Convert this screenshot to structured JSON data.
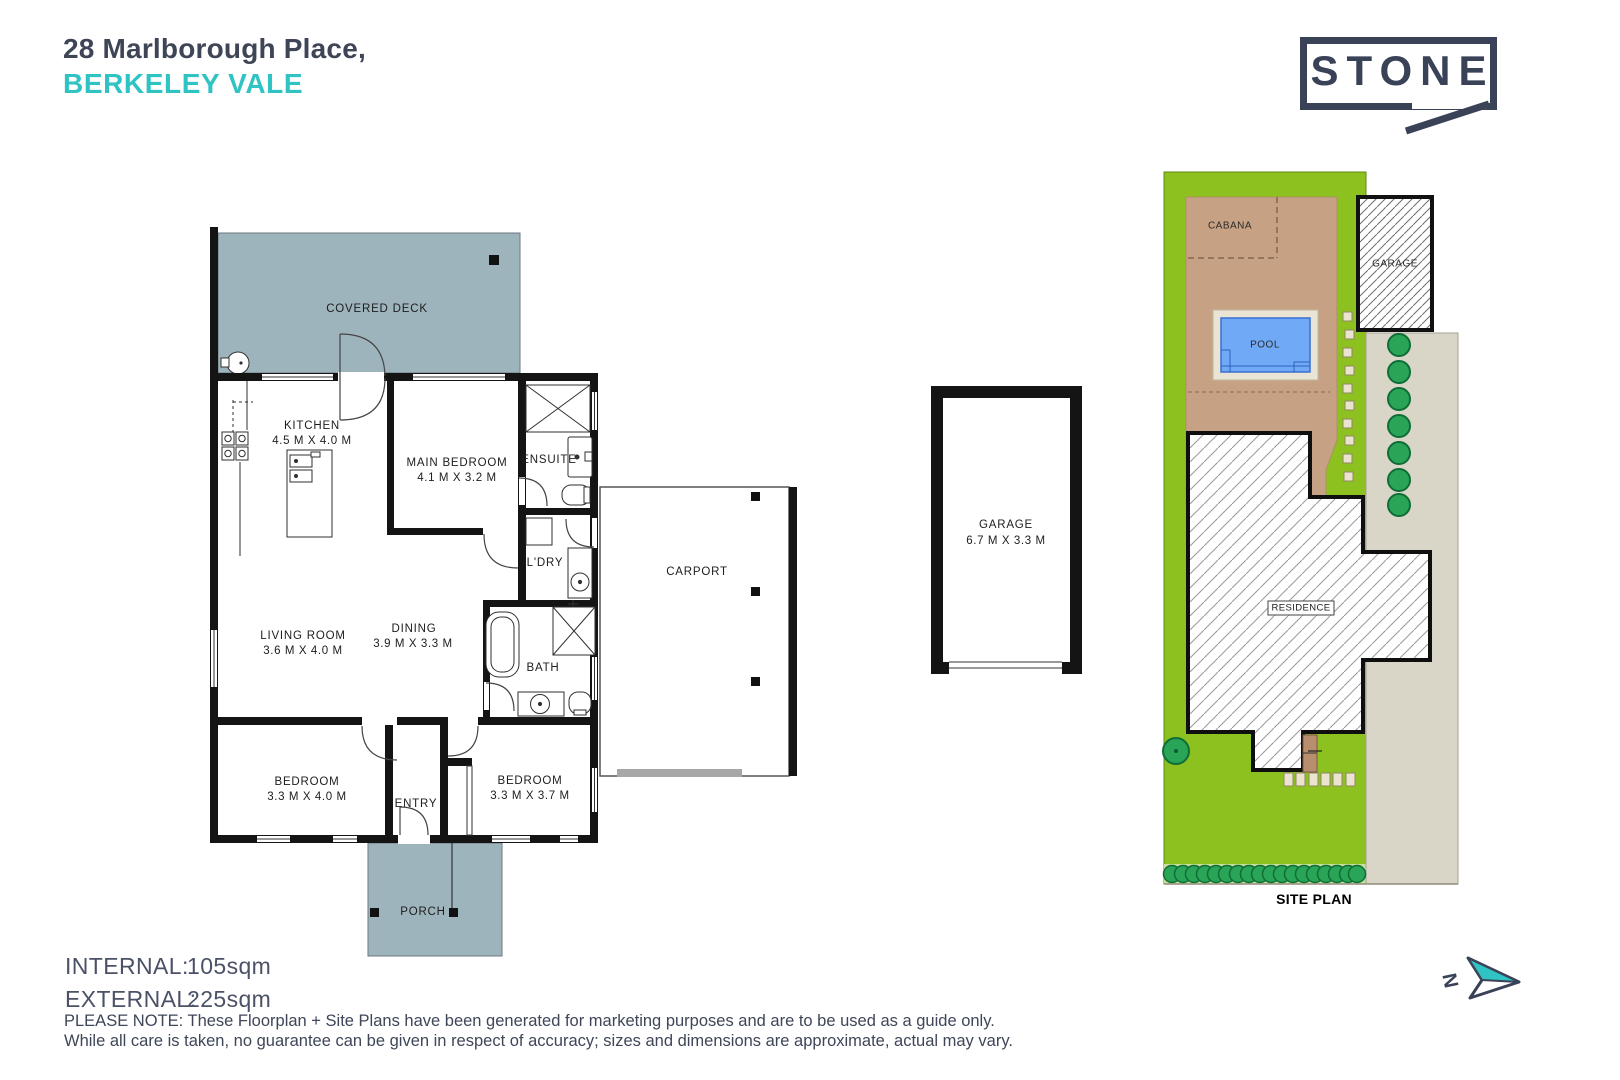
{
  "header": {
    "address_line1": "28 Marlborough Place,",
    "address_line2": "BERKELEY VALE"
  },
  "brand": {
    "logo_text": "STONE",
    "navy": "#3a4257",
    "teal": "#2fc3c3"
  },
  "floorplan": {
    "rooms": {
      "covered_deck": {
        "name": "COVERED DECK"
      },
      "kitchen": {
        "name": "KITCHEN",
        "dims": "4.5 M X 4.0 M"
      },
      "main_bedroom": {
        "name": "MAIN BEDROOM",
        "dims": "4.1 M X 3.2 M"
      },
      "ensuite": {
        "name": "ENSUITE"
      },
      "laundry": {
        "name": "L'DRY"
      },
      "carport": {
        "name": "CARPORT"
      },
      "living_room": {
        "name": "LIVING ROOM",
        "dims": "3.6 M X 4.0 M"
      },
      "dining": {
        "name": "DINING",
        "dims": "3.9 M X 3.3 M"
      },
      "bath": {
        "name": "BATH"
      },
      "bedroom_left": {
        "name": "BEDROOM",
        "dims": "3.3 M X 4.0 M"
      },
      "entry": {
        "name": "ENTRY"
      },
      "bedroom_right": {
        "name": "BEDROOM",
        "dims": "3.3 M X 3.7 M"
      },
      "porch": {
        "name": "PORCH"
      }
    }
  },
  "garage_plan": {
    "name": "GARAGE",
    "dims": "6.7 M X 3.3 M"
  },
  "site_plan": {
    "cabana": "CABANA",
    "garage": "GARAGE",
    "pool": "POOL",
    "residence": "RESIDENCE",
    "caption": "SITE PLAN",
    "colors": {
      "grass": "#8cc11f",
      "dirt": "#c7a183",
      "pool_water": "#70a9f6",
      "driveway": "#d9d6c8",
      "deck": "#9eb4bc"
    }
  },
  "areas": {
    "internal_label": "INTERNAL:",
    "internal_value": "105sqm",
    "external_label": "EXTERNAL:",
    "external_value": "225sqm"
  },
  "disclaimer": {
    "line1": "PLEASE NOTE: These Floorplan + Site Plans have been generated for marketing purposes and are to be used as a guide only.",
    "line2": "While all care is taken, no guarantee can be given in respect of accuracy; sizes and dimensions are approximate, actual may vary."
  },
  "compass": {
    "north_label": "N"
  }
}
